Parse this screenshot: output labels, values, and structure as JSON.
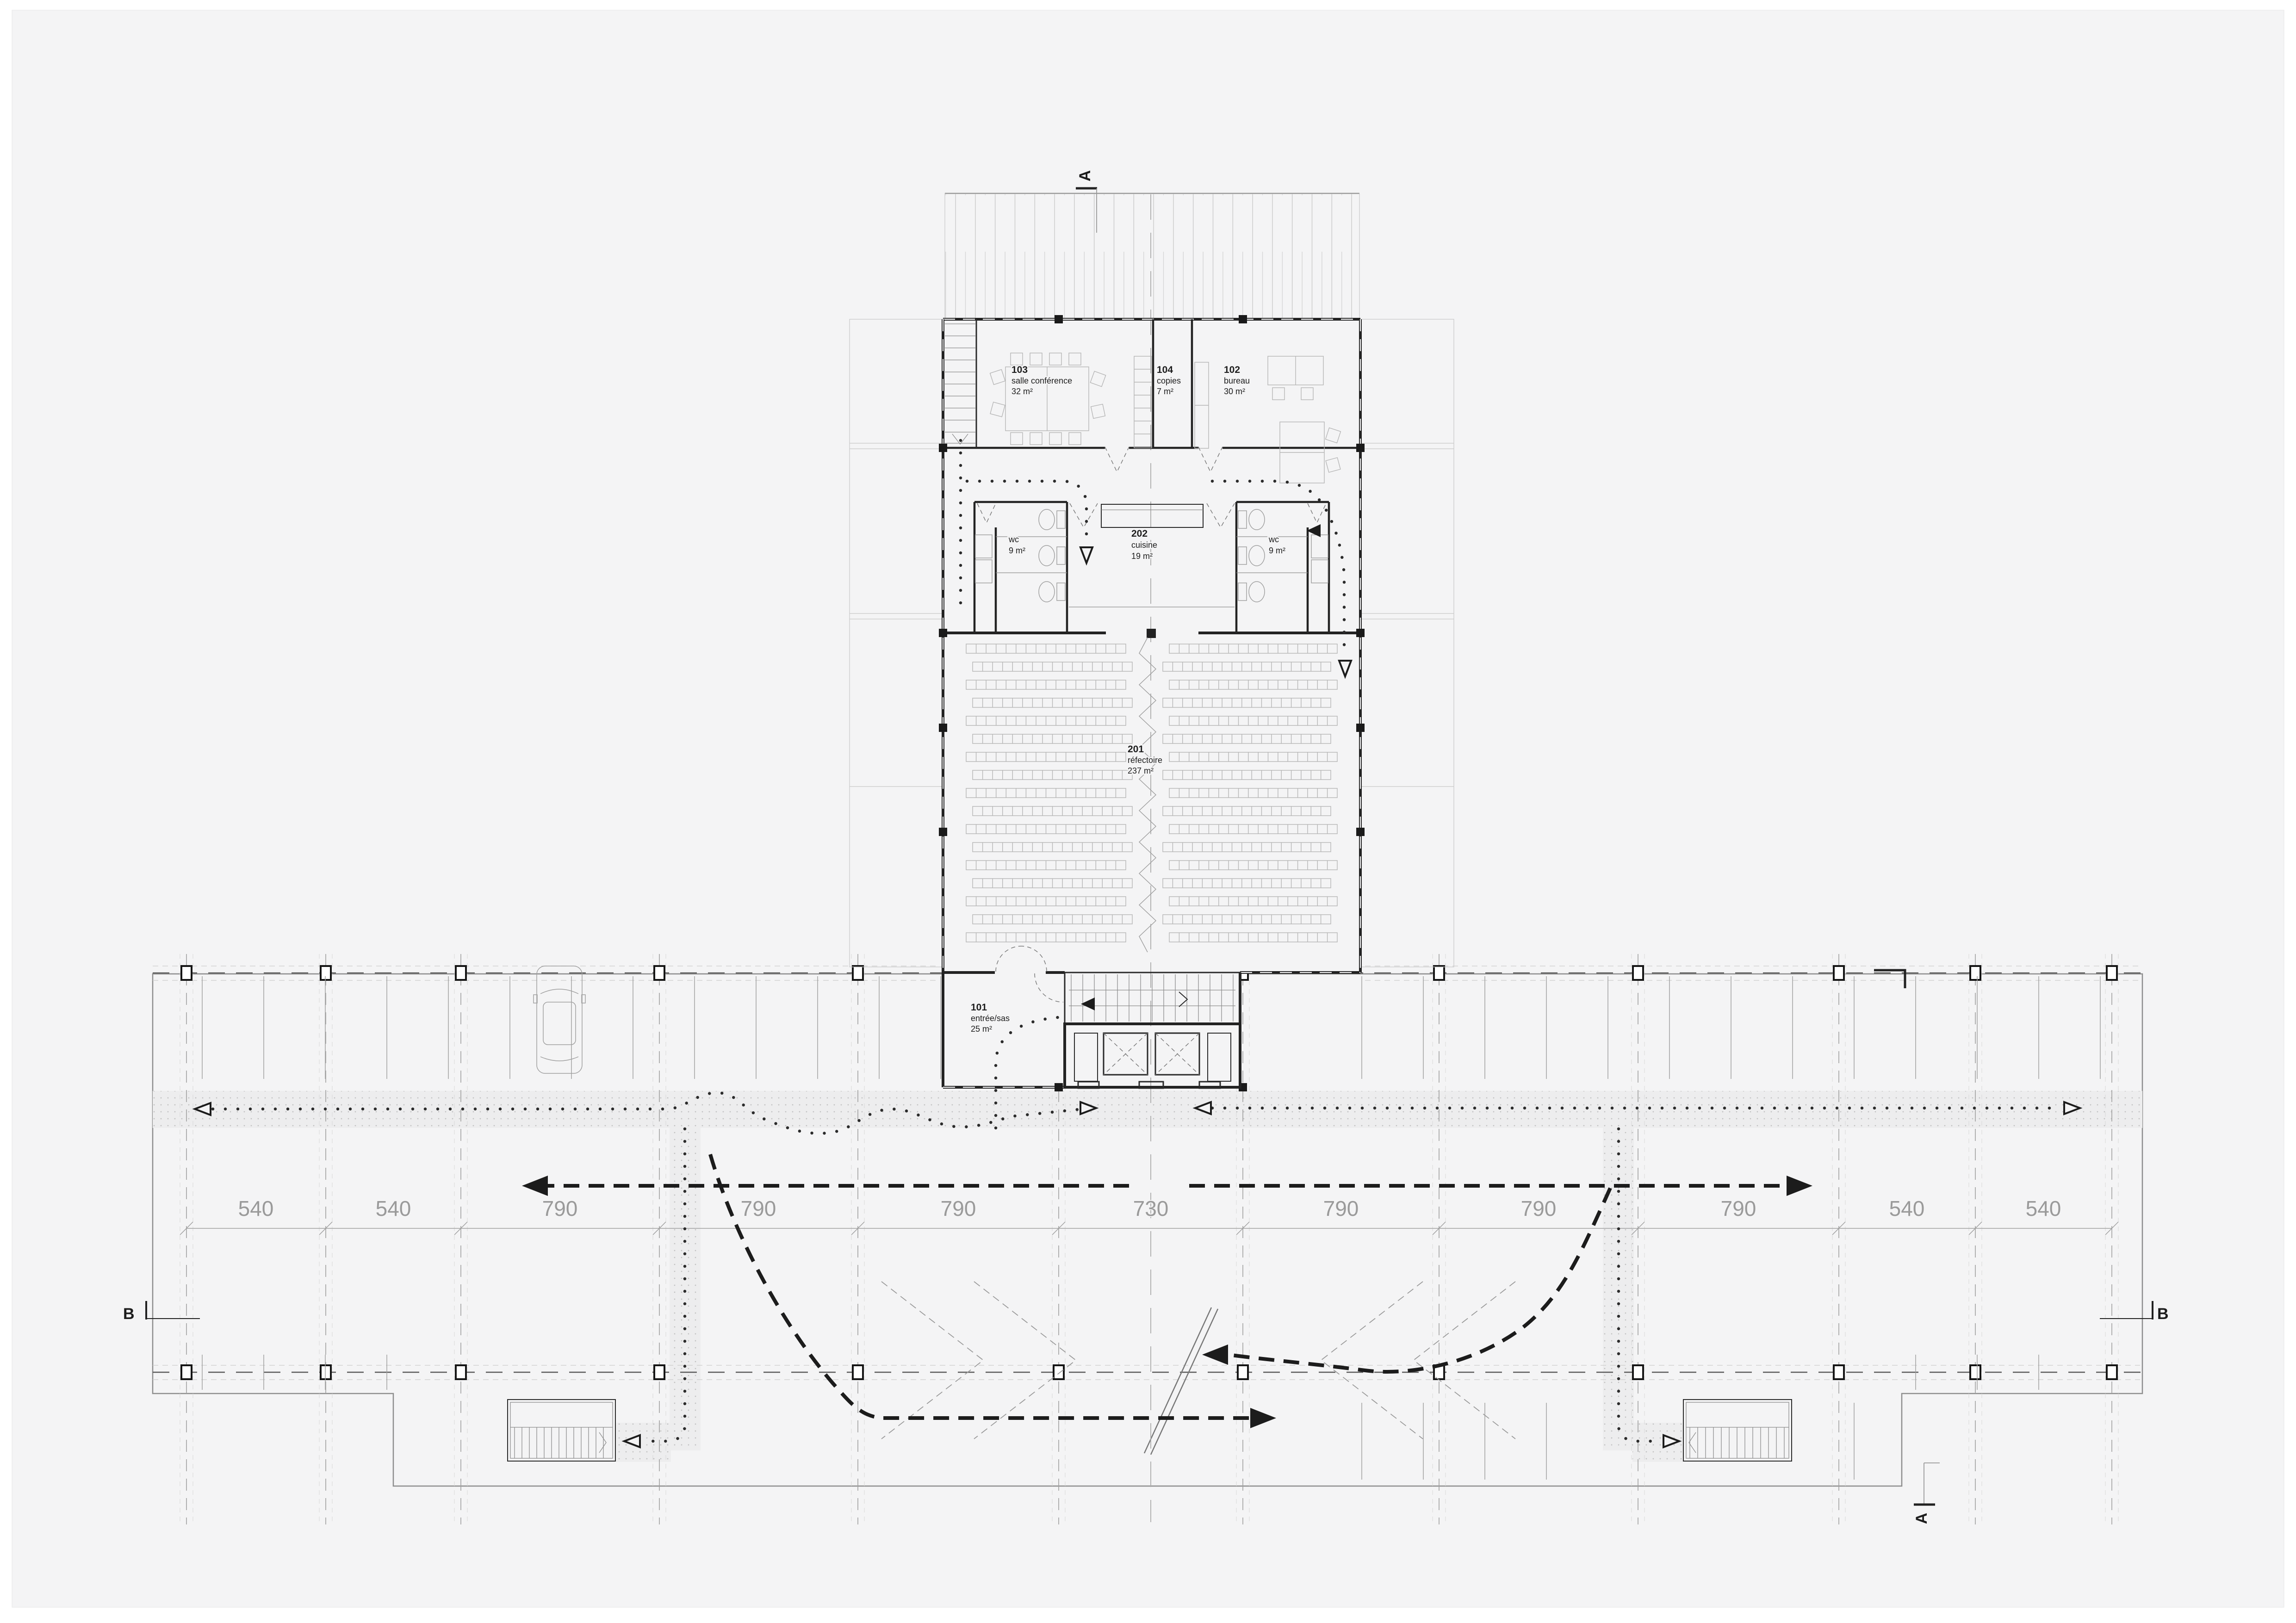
{
  "drawing": {
    "type": "architectural floor plan",
    "rooms": {
      "r103": {
        "number": "103",
        "name": "salle conférence",
        "area": "32 m²"
      },
      "r104": {
        "number": "104",
        "name": "copies",
        "area": "7 m²"
      },
      "r102": {
        "number": "102",
        "name": "bureau",
        "area": "30 m²"
      },
      "r202": {
        "number": "202",
        "name": "cuisine",
        "area": "19 m²"
      },
      "wc_left": {
        "name": "wc",
        "area": "9 m²"
      },
      "wc_right": {
        "name": "wc",
        "area": "9 m²"
      },
      "r201": {
        "number": "201",
        "name": "réfectoire",
        "area": "237 m²"
      },
      "r101": {
        "number": "101",
        "name": "entrée/sas",
        "area": "25 m²"
      }
    },
    "dimensions": {
      "values": [
        "540",
        "540",
        "790",
        "790",
        "790",
        "730",
        "790",
        "790",
        "790",
        "540",
        "540"
      ]
    },
    "sections": {
      "a_top": "A",
      "a_bottom": "A",
      "b_left": "B",
      "b_right": "B"
    },
    "colors": {
      "background": "#f4f4f5",
      "walls": "#232323",
      "grid": "#9f9f9f",
      "dimension_text": "#9a9a9a",
      "route": "#1c1c1c"
    }
  }
}
